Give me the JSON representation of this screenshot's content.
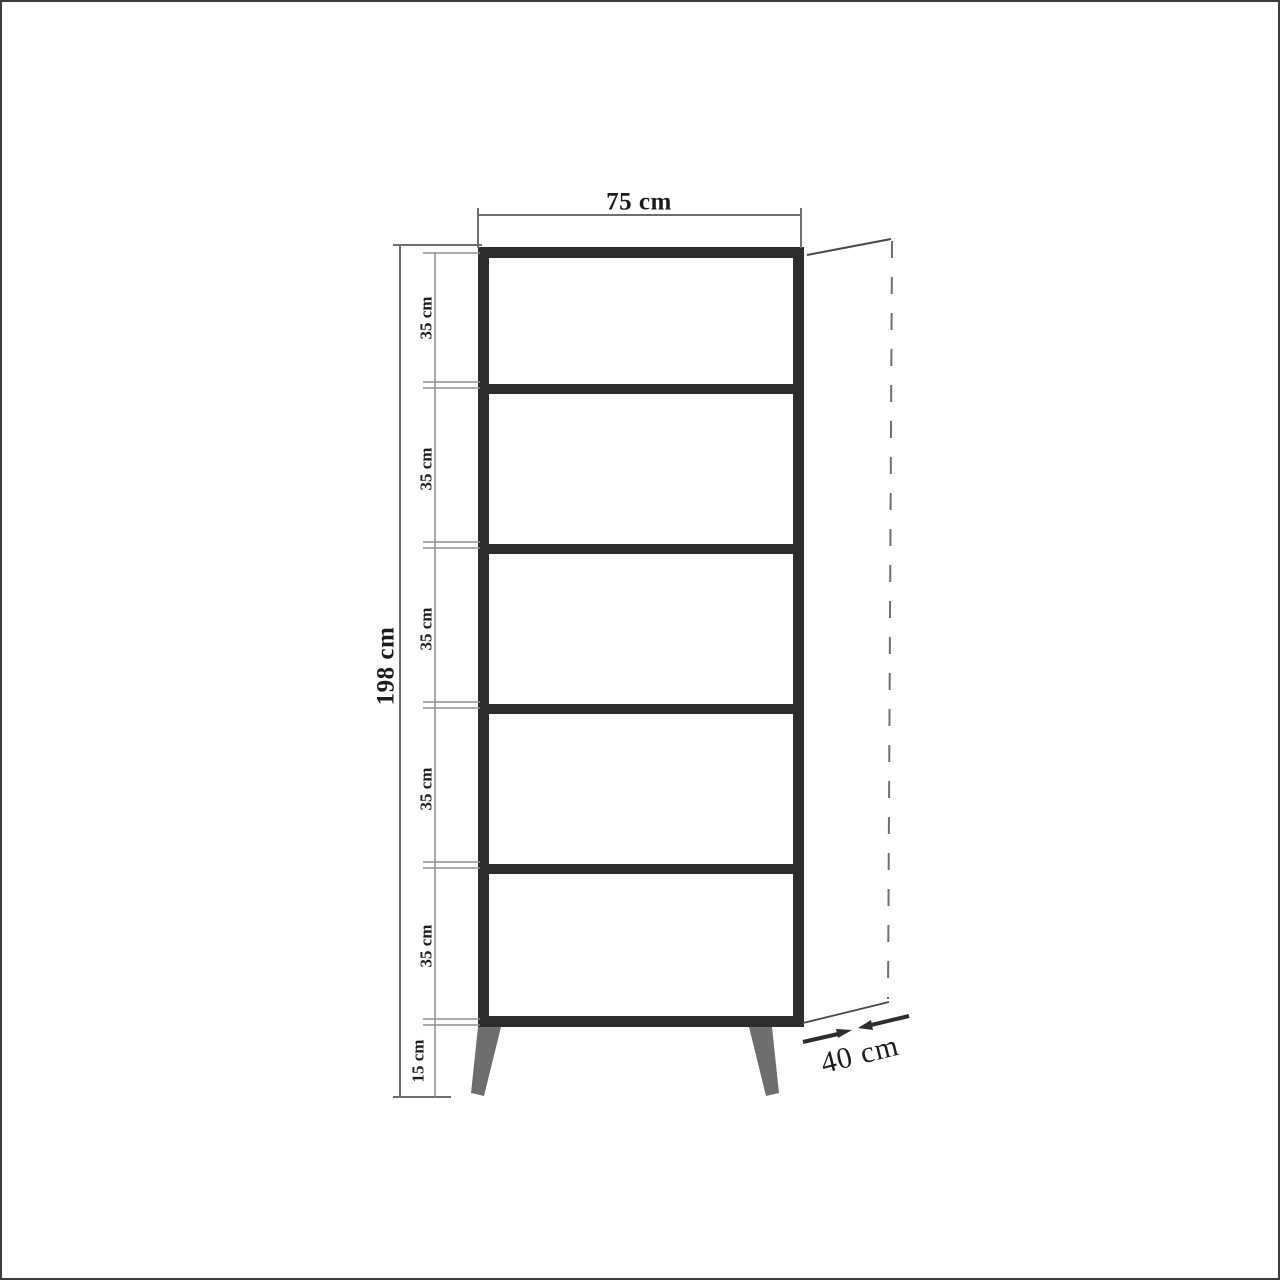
{
  "diagram": {
    "type": "furniture-dimension-drawing",
    "subject": "five-shelf bookcase front elevation with depth projection",
    "labels": {
      "width": "75 cm",
      "height": "198 cm",
      "depth": "40 cm",
      "leg_height": "15 cm",
      "compartments": [
        "35 cm",
        "35 cm",
        "35 cm",
        "35 cm",
        "35 cm"
      ]
    },
    "colors": {
      "body_stroke": "#2d2d2d",
      "leg_fill": "#6e6e6e",
      "dimension_line": "#6f6f6f",
      "tick_line": "#8f8f8f",
      "projection_line": "#4a4a4a",
      "text": "#1c1c1c",
      "page_border": "#3e3e3e",
      "background": "#ffffff"
    }
  }
}
